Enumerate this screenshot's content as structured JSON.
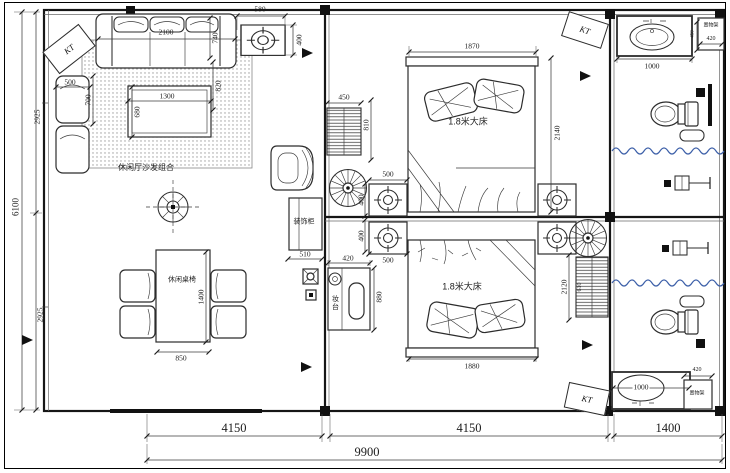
{
  "drawing": {
    "labels": {
      "sofa_group": "休闲厅沙发组合",
      "dining_set": "休闲桌椅",
      "decor_cabinet": "装饰柜",
      "vanity": "妆台",
      "bed_master_1": "1.8米大床",
      "bed_master_2": "1.8米大床",
      "shelf_1": "置物架",
      "shelf_2": "置物架",
      "ac_1": "KT",
      "ac_2": "KT",
      "ac_3": "KT"
    },
    "dims": {
      "left_upper": "2925",
      "left_total": "6100",
      "left_lower": "2925",
      "lamp_table_w": "580",
      "lamp_table_d": "400",
      "sofa_w": "2100",
      "sofa_d": "740",
      "sofa_gap": "820",
      "armchair_w": "500",
      "armchair_d": "700",
      "coffee_table_w": "1300",
      "coffee_table_d": "680",
      "dining_l": "1400",
      "dining_w": "850",
      "cabinet_w": "510",
      "vanity_w": "420",
      "vanity_l": "880",
      "radiator1_w": "450",
      "radiator1_l": "810",
      "bed1_w": "1870",
      "bed1_l": "2140",
      "nightstand_top": "500",
      "nightstand_side_1": "400",
      "nightstand_side_2": "400",
      "nightstand_bottom": "500",
      "bed2_w": "1880",
      "radiator2_l": "2120",
      "radiator2_w": "610",
      "sink1_w": "1000",
      "sink1_d": "450",
      "shelf1_w": "420",
      "sink2_w": "1000",
      "shelf2_w": "420",
      "bottom_module_left": "4150",
      "bottom_module_mid": "4150",
      "bottom_module_right": "1400",
      "bottom_total": "9900"
    },
    "colors": {
      "wall": "#161616",
      "dim_line": "#3d3d3d",
      "shower_curtain": "#3c5fa8",
      "paper": "#ffffff"
    }
  }
}
